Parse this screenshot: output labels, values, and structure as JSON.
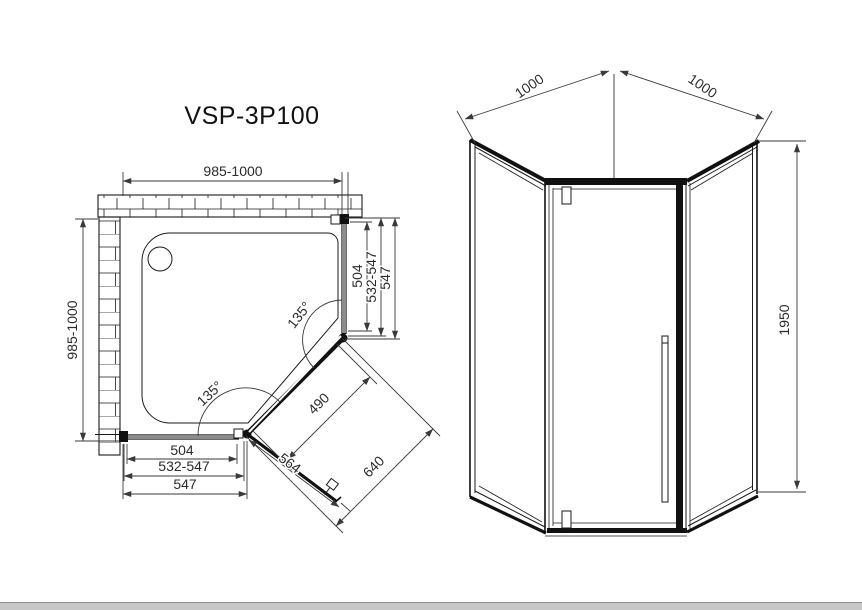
{
  "title": "VSP-3P100",
  "plan": {
    "width_top": "985-1000",
    "depth_left": "985-1000",
    "right_dims": [
      "504",
      "532-547",
      "547"
    ],
    "bottom_dims": [
      "504",
      "532-547",
      "547"
    ],
    "door": {
      "glass_width": "490",
      "door_width": "564",
      "opening": "640"
    },
    "angles": {
      "top": "135°",
      "bottom": "135°"
    }
  },
  "elevation": {
    "width_left": "1000",
    "width_right": "1000",
    "height": "1950"
  },
  "colors": {
    "line": "#1a1a1a",
    "dimension": "#3a3a3a",
    "bottom_bar": "#c7c7c7"
  }
}
